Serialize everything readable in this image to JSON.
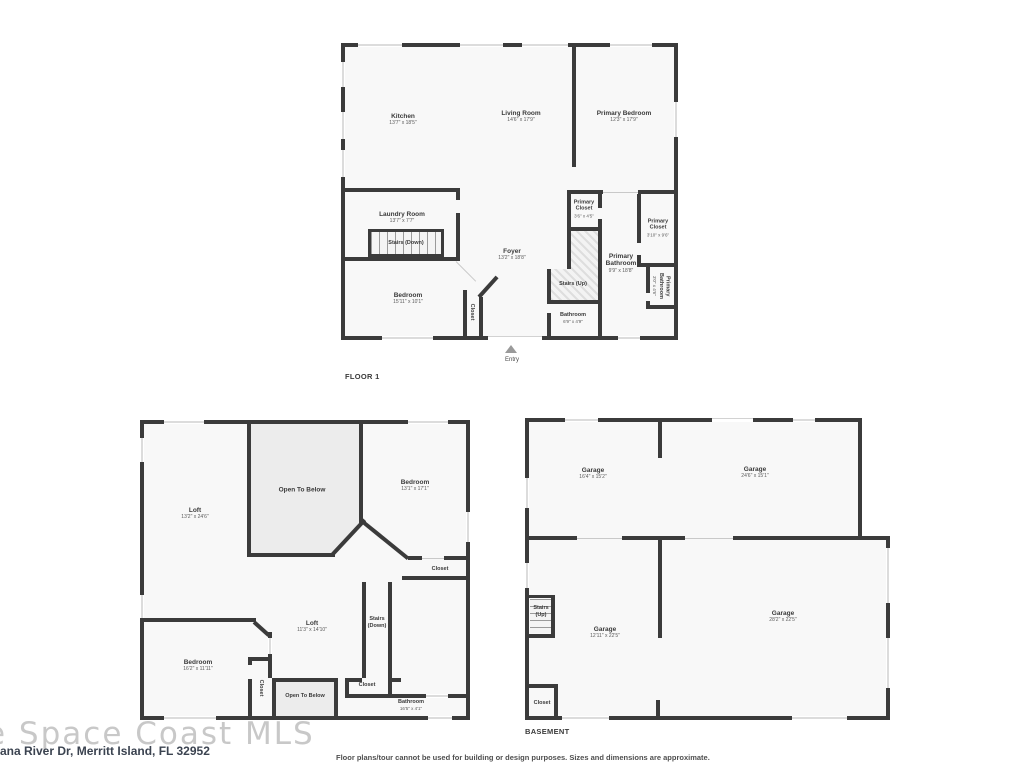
{
  "page": {
    "watermark": "e Space Coast MLS",
    "address": "ana River Dr, Merritt Island, FL 32952",
    "disclaimer": "Floor plans/tour cannot be used for building or design purposes. Sizes and dimensions are approximate."
  },
  "floor1": {
    "title": "FLOOR 1",
    "entry": "Entry",
    "rooms": {
      "kitchen": {
        "name": "Kitchen",
        "dims": "13'7\" x 18'5\""
      },
      "living": {
        "name": "Living Room",
        "dims": "14'6\" x 17'9\""
      },
      "primary_bedroom": {
        "name": "Primary Bedroom",
        "dims": "12'3\" x 17'9\""
      },
      "laundry": {
        "name": "Laundry Room",
        "dims": "13'7\" x 7'7\""
      },
      "stairs_down": {
        "name": "Stairs (Down)"
      },
      "bedroom": {
        "name": "Bedroom",
        "dims": "15'11\" x 10'1\""
      },
      "closet": {
        "name": "Closet"
      },
      "foyer": {
        "name": "Foyer",
        "dims": "13'2\" x 18'8\""
      },
      "primary_closet_a": {
        "name": "Primary Closet",
        "dims": "3'6\" x 4'5\""
      },
      "stairs_up": {
        "name": "Stairs (Up)"
      },
      "bathroom": {
        "name": "Bathroom",
        "dims": "6'9\" x 4'9\""
      },
      "primary_bathroom": {
        "name": "Primary Bathroom",
        "dims": "9'9\" x 18'8\""
      },
      "primary_closet_b": {
        "name": "Primary Closet",
        "dims": "3'10\" x 9'6\""
      },
      "primary_bathroom_small": {
        "name": "Primary Bathroom",
        "dims": "3'0\" x 4'6\""
      }
    }
  },
  "floor2": {
    "rooms": {
      "loft_big": {
        "name": "Loft",
        "dims": "13'2\" x 24'6\""
      },
      "open_below_1": {
        "name": "Open To Below"
      },
      "bedroom_top": {
        "name": "Bedroom",
        "dims": "13'1\" x 17'1\""
      },
      "closet_top": {
        "name": "Closet"
      },
      "loft_small": {
        "name": "Loft",
        "dims": "11'3\" x 14'10\""
      },
      "stairs_down": {
        "name": "Stairs",
        "name2": "(Down)"
      },
      "bedroom_bottom": {
        "name": "Bedroom",
        "dims": "16'2\" x 11'11\""
      },
      "closet_left": {
        "name": "Closet"
      },
      "open_below_2": {
        "name": "Open To Below"
      },
      "closet_mid": {
        "name": "Closet"
      },
      "bathroom": {
        "name": "Bathroom",
        "dims": "16'5\" x 4'1\""
      }
    }
  },
  "basement": {
    "title": "BASEMENT",
    "rooms": {
      "garage_tl": {
        "name": "Garage",
        "dims": "16'4\" x 15'2\""
      },
      "garage_tr": {
        "name": "Garage",
        "dims": "24'6\" x 15'1\""
      },
      "stairs_up": {
        "name": "Stairs",
        "name2": "(Up)"
      },
      "garage_bl": {
        "name": "Garage",
        "dims": "12'11\" x 22'5\""
      },
      "garage_br": {
        "name": "Garage",
        "dims": "28'2\" x 22'5\""
      },
      "closet": {
        "name": "Closet"
      }
    }
  }
}
